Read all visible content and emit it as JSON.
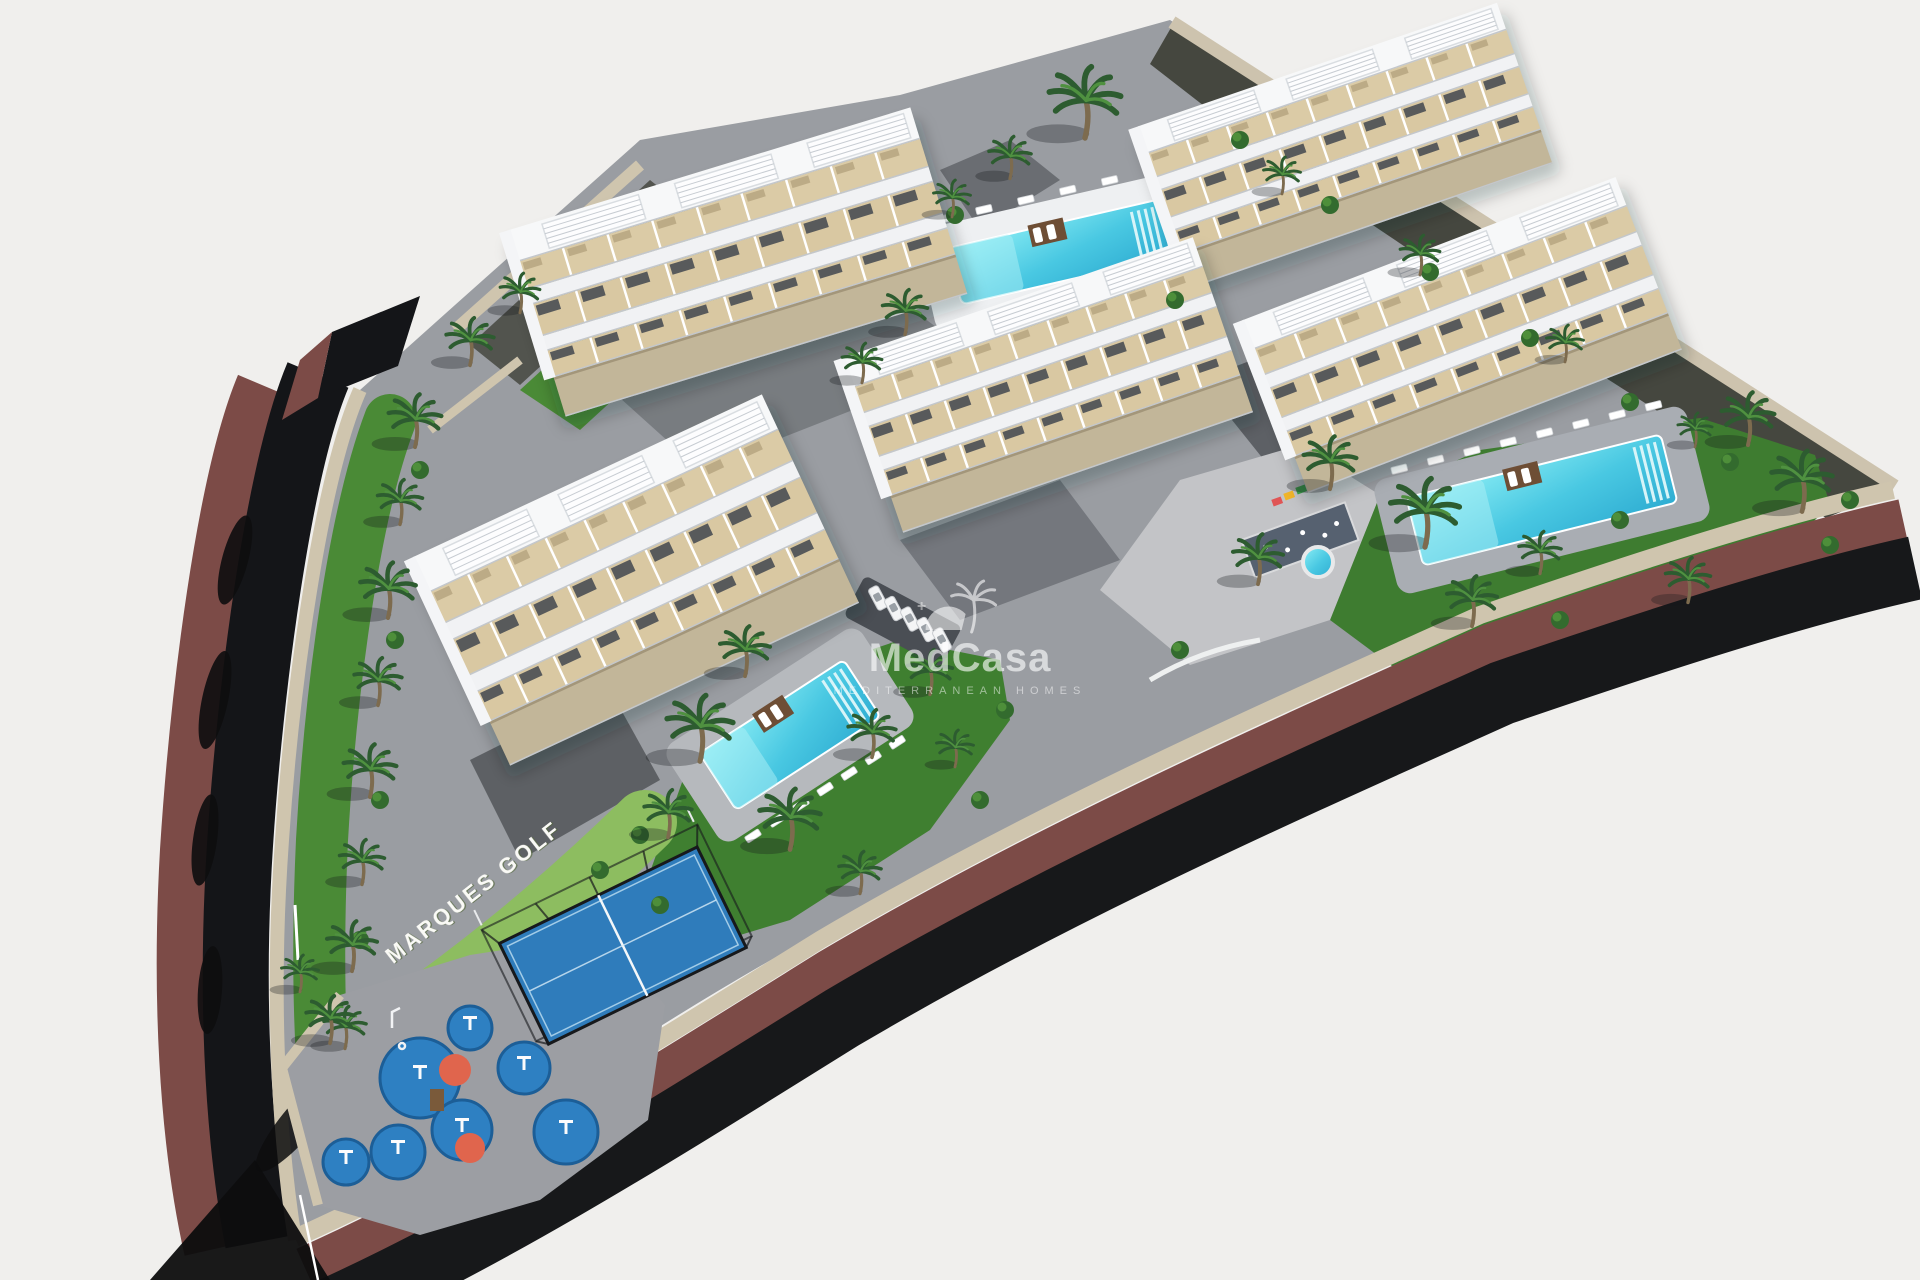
{
  "meta": {
    "type": "aerial-3d-architectural-render",
    "subject": "Marques Golf residential development",
    "view": "isometric aerial view on white background"
  },
  "watermark": {
    "brand": "MedCasa",
    "tagline": "MEDITERRANEAN HOMES",
    "icon": "palm-tree-icon"
  },
  "ground_label": {
    "text": "MARQUES GOLF"
  },
  "palette": {
    "background": "#f0efed",
    "road_asphalt": "#17181a",
    "embankment": "#7c4b47",
    "stone_wall": "#cfc5ae",
    "pavers": "#9a9da2",
    "lawn": "#428233",
    "hedge": "#8dbd60",
    "pool_water_light": "#8ceef5",
    "pool_water_deep": "#2fadd2",
    "padel_court": "#2f7cbb",
    "playground_pad": "#2e80c2",
    "playground_accent": "#e0654d",
    "building_white": "#f7f8f9",
    "terrace_tan": "#d9c8a2",
    "rock_slope": "#45473f"
  },
  "scene": {
    "legend": {
      "apartment_blocks": 5,
      "swimming_pools": 3,
      "kids_round_pool": 1,
      "padel_courts": 1,
      "playground_areas": 2,
      "parked_cars": 5
    },
    "buildings": [
      {
        "x": 738,
        "y": 262,
        "w": 420,
        "h": 195,
        "angle": -17
      },
      {
        "x": 1345,
        "y": 145,
        "w": 380,
        "h": 170,
        "angle": -19
      },
      {
        "x": 1048,
        "y": 385,
        "w": 370,
        "h": 185,
        "angle": -19
      },
      {
        "x": 1462,
        "y": 335,
        "w": 400,
        "h": 185,
        "angle": -21
      },
      {
        "x": 636,
        "y": 580,
        "w": 385,
        "h": 230,
        "angle": -25
      }
    ],
    "pools": [
      {
        "x": 1060,
        "y": 252,
        "w": 215,
        "h": 58,
        "angle": -13,
        "deck": "#eef0f2",
        "lounge": 6,
        "side": -1,
        "platform": true
      },
      {
        "x": 1542,
        "y": 500,
        "w": 262,
        "h": 70,
        "angle": -14,
        "deck": "#a9adb3",
        "lounge": 8,
        "side": -1,
        "platform": true
      },
      {
        "x": 790,
        "y": 735,
        "w": 172,
        "h": 68,
        "angle": -33,
        "deck": "#b6b9bd",
        "lounge": 7,
        "side": 1,
        "platform": true
      }
    ],
    "kids_pool": {
      "x": 1318,
      "y": 562,
      "r": 15
    },
    "cars": {
      "x": 878,
      "y": 598,
      "step_x": 16,
      "step_y": 10.5,
      "count": 5,
      "angle": 62
    },
    "playground": {
      "pads": [
        [
          420,
          1078,
          40
        ],
        [
          462,
          1130,
          30
        ],
        [
          398,
          1152,
          27
        ],
        [
          524,
          1068,
          26
        ],
        [
          566,
          1132,
          32
        ],
        [
          346,
          1162,
          23
        ],
        [
          470,
          1028,
          22
        ]
      ],
      "accents": [
        [
          455,
          1070,
          16
        ],
        [
          470,
          1148,
          15
        ]
      ],
      "equipment": [
        [
          420,
          1075
        ],
        [
          462,
          1128
        ],
        [
          398,
          1150
        ],
        [
          524,
          1066
        ],
        [
          566,
          1130
        ],
        [
          346,
          1160
        ],
        [
          470,
          1026
        ]
      ],
      "tower": [
        437,
        1100
      ]
    },
    "palms": [
      [
        415,
        430,
        1
      ],
      [
        400,
        510,
        0.85
      ],
      [
        388,
        600,
        1.05
      ],
      [
        378,
        690,
        0.9
      ],
      [
        370,
        780,
        1
      ],
      [
        362,
        870,
        0.85
      ],
      [
        352,
        955,
        0.95
      ],
      [
        345,
        1035,
        0.8
      ],
      [
        470,
        350,
        0.9
      ],
      [
        520,
        300,
        0.75
      ],
      [
        1085,
        115,
        1.35
      ],
      [
        1010,
        165,
        0.8
      ],
      [
        952,
        205,
        0.7
      ],
      [
        905,
        320,
        0.85
      ],
      [
        862,
        370,
        0.75
      ],
      [
        745,
        660,
        0.95
      ],
      [
        700,
        740,
        1.25
      ],
      [
        668,
        822,
        0.9
      ],
      [
        790,
        830,
        1.15
      ],
      [
        872,
        742,
        0.9
      ],
      [
        930,
        680,
        0.85
      ],
      [
        955,
        755,
        0.7
      ],
      [
        860,
        880,
        0.8
      ],
      [
        1258,
        568,
        0.95
      ],
      [
        1330,
        472,
        1
      ],
      [
        1425,
        525,
        1.3
      ],
      [
        1472,
        610,
        0.95
      ],
      [
        1540,
        560,
        0.8
      ],
      [
        1748,
        428,
        1
      ],
      [
        1802,
        492,
        1.15
      ],
      [
        1688,
        588,
        0.85
      ],
      [
        1282,
        182,
        0.7
      ],
      [
        1420,
        262,
        0.75
      ],
      [
        1565,
        350,
        0.7
      ],
      [
        1695,
        436,
        0.65
      ],
      [
        330,
        1028,
        0.9
      ],
      [
        300,
        980,
        0.7
      ]
    ],
    "shrubs": [
      [
        1240,
        140
      ],
      [
        1330,
        205
      ],
      [
        1430,
        272
      ],
      [
        1530,
        338
      ],
      [
        1630,
        402
      ],
      [
        1730,
        462
      ],
      [
        955,
        215
      ],
      [
        1175,
        300
      ],
      [
        660,
        905
      ],
      [
        980,
        800
      ],
      [
        1005,
        710
      ],
      [
        1180,
        650
      ],
      [
        1560,
        620
      ],
      [
        1620,
        520
      ],
      [
        1850,
        500
      ],
      [
        1830,
        545
      ],
      [
        420,
        470
      ],
      [
        395,
        640
      ],
      [
        380,
        800
      ],
      [
        360,
        940
      ],
      [
        640,
        835
      ],
      [
        600,
        870
      ]
    ]
  }
}
